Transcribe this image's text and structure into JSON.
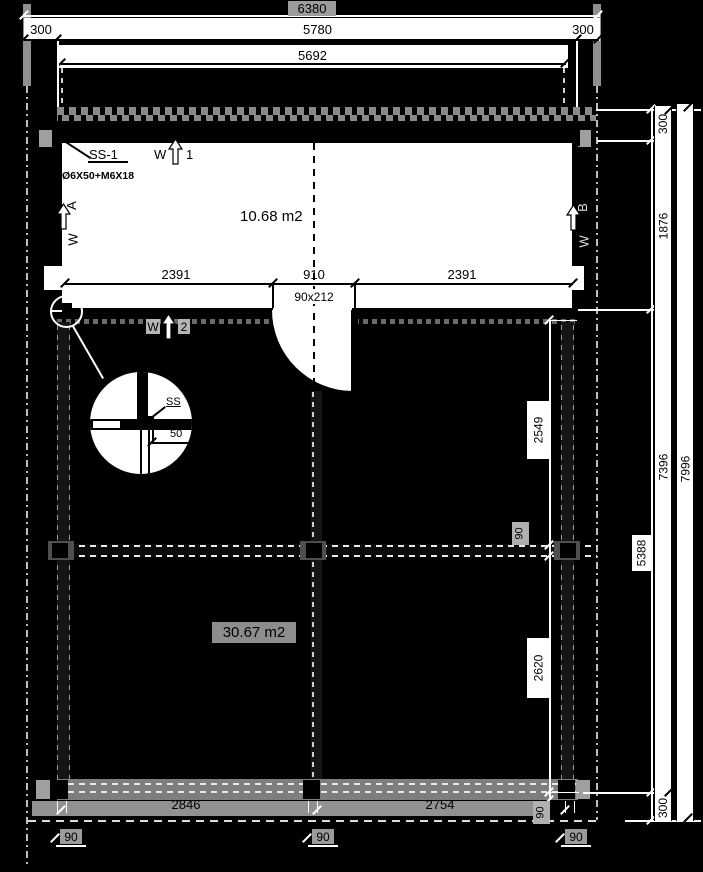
{
  "colors": {
    "background": "#000000",
    "line_light": "#ffffff",
    "line_dark": "#000000",
    "panel": "#ffffff",
    "hatch_gray": "#8f8f8f"
  },
  "top_dimensions": {
    "overall": "6380",
    "left_overhang": "300",
    "wall_span": "5780",
    "right_overhang": "300",
    "inner_span": "5692"
  },
  "plan": {
    "room_area": "10.68 m2",
    "detail_ref": "SS-1",
    "fastener_spec": "Ø6X50+M6X18",
    "room_dims": {
      "left": "2391",
      "opening": "910",
      "right": "2391",
      "door_size": "90x212"
    },
    "wall_markers": {
      "top": {
        "letter": "W",
        "id": "1"
      },
      "left": {
        "letter": "W",
        "id": "A"
      },
      "right": {
        "letter": "W",
        "id": "B"
      },
      "bottom": {
        "letter": "W",
        "id": "2"
      }
    }
  },
  "terrace": {
    "area": "30.67 m2"
  },
  "right_dimensions": {
    "outer_total": "7996",
    "inner_total": "7396",
    "chain": [
      "300",
      "1876",
      "5388",
      "300"
    ],
    "terrace_chain": [
      "2549",
      "90",
      "2620",
      "90"
    ]
  },
  "bottom_dimensions": {
    "left_bay": "2846",
    "right_bay": "2754",
    "post_widths": [
      "90",
      "90",
      "90"
    ]
  },
  "detail_callout": {
    "label": "SS",
    "offset_dim": "50"
  }
}
